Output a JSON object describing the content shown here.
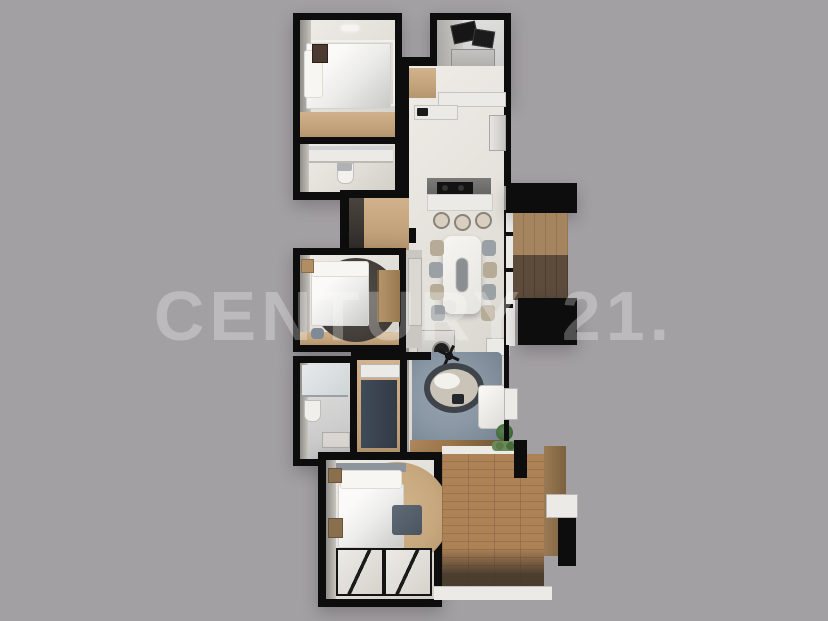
{
  "watermark": {
    "text": "CENTURY 21.",
    "color": "#bcb9bc"
  },
  "palette": {
    "background": "#a3a0a3",
    "wall": "#0d0d0d",
    "floor_light": "#e9e6e1",
    "wood_light": "#c9ab87",
    "wood_deck": "#a87f52",
    "wood_dark": "#5d4b3b",
    "rug_dark": "#45403b",
    "rug_tan": "#c7a87e",
    "rug_blue": "#8a97a5",
    "cabinet_navy": "#3a434f",
    "plant_green": "#4a6b3f"
  },
  "floorplan": {
    "type": "3d-rendered-top-down-floor-plan",
    "rooms": [
      {
        "name": "bedroom-top",
        "contents": [
          "double-bed",
          "pillows",
          "wall-art",
          "wood-floor-strip",
          "ceiling-light"
        ]
      },
      {
        "name": "bathroom-top",
        "contents": [
          "vanity-counter",
          "mirror",
          "toilet"
        ]
      },
      {
        "name": "utility-room",
        "contents": [
          "open-cabinet-doors",
          "washer",
          "dryer"
        ]
      },
      {
        "name": "kitchen",
        "contents": [
          "counters",
          "cooktop",
          "island",
          "bar-stools",
          "fridge",
          "entry-wood-floor"
        ]
      },
      {
        "name": "dining-room",
        "contents": [
          "long-dining-table",
          "eight-chairs",
          "desk",
          "office-chair",
          "side-table"
        ]
      },
      {
        "name": "bedroom-middle",
        "contents": [
          "double-bed",
          "round-dark-rug",
          "wardrobe",
          "nightstand",
          "pouf",
          "wood-floor-strip"
        ]
      },
      {
        "name": "balcony",
        "contents": [
          "two-tone-wood-floor",
          "window-wall"
        ]
      },
      {
        "name": "bathroom-lower",
        "contents": [
          "shower",
          "toilet",
          "vanity"
        ]
      },
      {
        "name": "hallway-closet",
        "contents": [
          "navy-wardrobe",
          "wood-floor",
          "shelf"
        ]
      },
      {
        "name": "living-room",
        "contents": [
          "blue-gray-rug",
          "round-lounge-chair",
          "ceiling-fan",
          "coffee-table",
          "chaise-sofa",
          "potted-plant",
          "tv-console",
          "wood-floor-strip"
        ]
      },
      {
        "name": "bedroom-master",
        "contents": [
          "double-bed",
          "round-tan-rug",
          "headboard",
          "nightstands",
          "blue-bench",
          "glass-partition-panels"
        ]
      },
      {
        "name": "terrace-deck",
        "contents": [
          "wood-plank-deck",
          "planter-box",
          "privacy-walls",
          "plants"
        ]
      }
    ]
  }
}
